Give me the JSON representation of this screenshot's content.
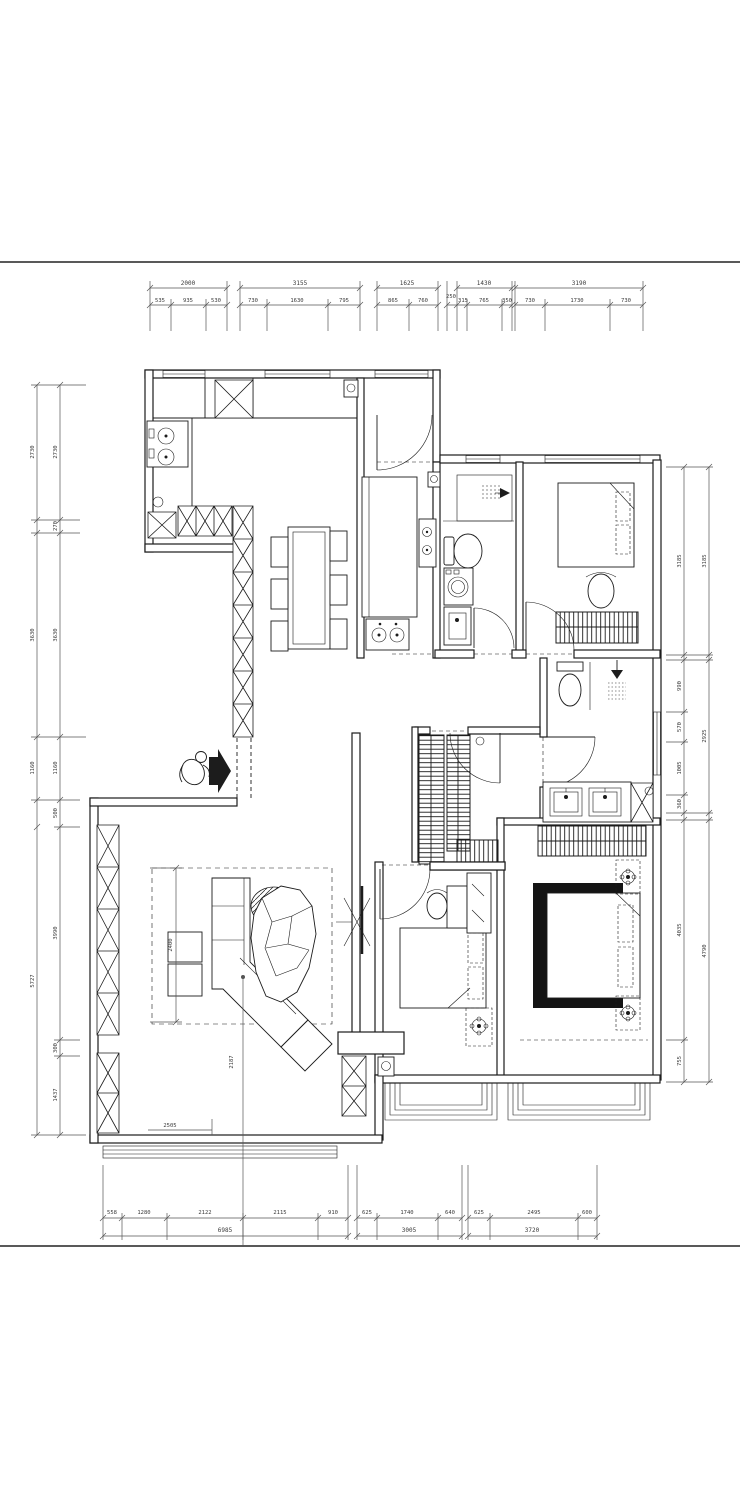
{
  "drawing": {
    "kind": "residential floor plan",
    "units": "mm"
  },
  "dims": {
    "top_overall": [
      "2000",
      "3155",
      "1625",
      "1430",
      "3190"
    ],
    "top_segments": [
      "535",
      "935",
      "530",
      "730",
      "1630",
      "795",
      "865",
      "760",
      "250",
      "315",
      "765",
      "350",
      "730",
      "1730",
      "730"
    ],
    "bottom_segments": [
      "558",
      "1280",
      "2122",
      "2115",
      "910",
      "625",
      "1740",
      "640",
      "625",
      "2495",
      "600"
    ],
    "bottom_overall": [
      "6985",
      "3005",
      "3720"
    ],
    "left_outer": [
      "2730",
      "3630",
      "1160",
      "5727"
    ],
    "left_inner": [
      "2730",
      "270",
      "3630",
      "1160",
      "500",
      "3990",
      "300",
      "1437"
    ],
    "right_inner": [
      "3185",
      "990",
      "570",
      "1005",
      "360",
      "4035",
      "755"
    ],
    "right_outer": [
      "3185",
      "2925",
      "4790"
    ],
    "interior": {
      "living_width": "2400",
      "living_depth": "2505",
      "leader": "2187"
    }
  }
}
